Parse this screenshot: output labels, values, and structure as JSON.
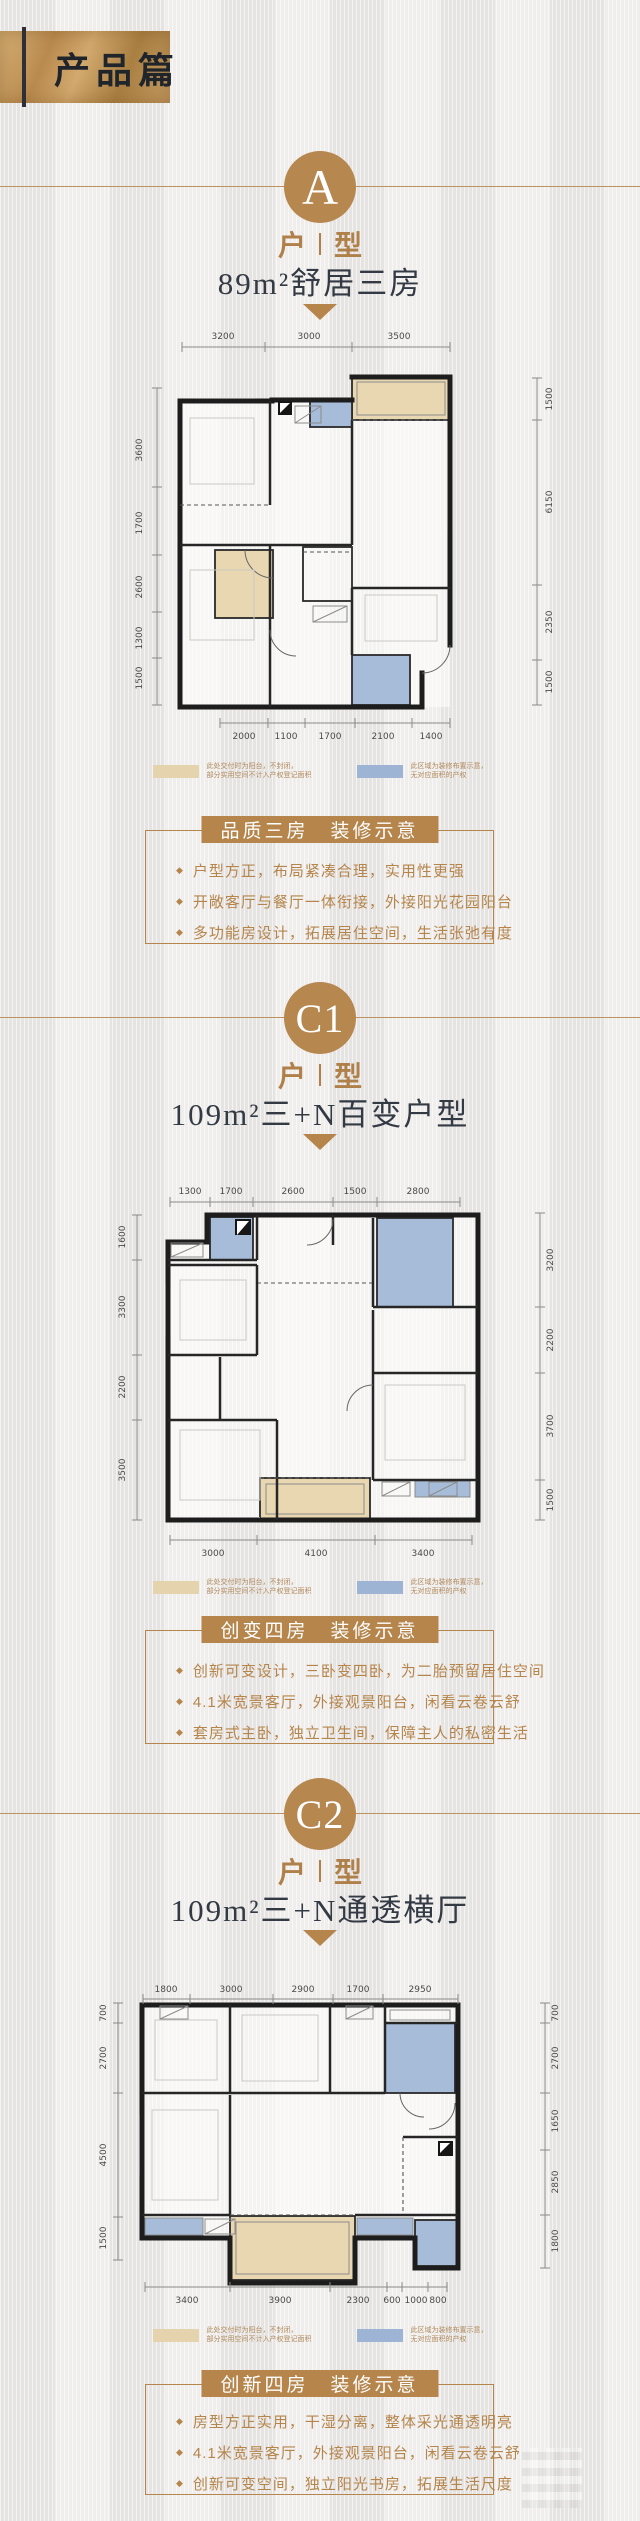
{
  "header": {
    "title": "产品篇"
  },
  "type_word": {
    "first": "户",
    "second": "型"
  },
  "ui": {
    "bullet_marker": "◆"
  },
  "colors": {
    "accent_gold": "#b6874e",
    "title_dark": "#333a44",
    "wall": "#1d1d1d",
    "balcony_tan": "#e9d7b2",
    "decor_blue": "#a6bcd8",
    "background": "#eceae8"
  },
  "legend": {
    "balcony_color": "#e5d3ad",
    "decor_color": "#9db4d4",
    "balcony_note_line1": "此处交付时为阳台，不封闭，",
    "balcony_note_line2": "部分实用空间不计入产权登记面积",
    "decor_note_line1": "此区域为装修布置示意，",
    "decor_note_line2": "无对应面积的产权"
  },
  "sections": [
    {
      "badge": "A",
      "subtitle": "89m²舒居三房",
      "plan": {
        "dims_top": [
          "3200",
          "3000",
          "3500"
        ],
        "dims_left": [
          "3600",
          "1700",
          "2600",
          "1300",
          "1500"
        ],
        "dims_right": [
          "1500",
          "6150",
          "2350",
          "1500"
        ],
        "dims_bottom": [
          "2000",
          "1100",
          "1700",
          "2100",
          "1400"
        ]
      },
      "info": {
        "title": "品质三房　装修示意",
        "bullets": [
          "户型方正，布局紧凑合理，实用性更强",
          "开敞客厅与餐厅一体衔接，外接阳光花园阳台",
          "多功能房设计，拓展居住空间，生活张弛有度"
        ]
      }
    },
    {
      "badge": "C1",
      "subtitle": "109m²三+N百变户型",
      "plan": {
        "dims_top": [
          "1300",
          "1700",
          "2600",
          "1500",
          "2800"
        ],
        "dims_left": [
          "1600",
          "3300",
          "2200",
          "3500"
        ],
        "dims_right": [
          "3200",
          "2200",
          "3700",
          "1500"
        ],
        "dims_bottom": [
          "3000",
          "4100",
          "3400"
        ]
      },
      "info": {
        "title": "创变四房　装修示意",
        "bullets": [
          "创新可变设计，三卧变四卧，为二胎预留居住空间",
          "4.1米宽景客厅，外接观景阳台，闲看云卷云舒",
          "套房式主卧，独立卫生间，保障主人的私密生活"
        ]
      }
    },
    {
      "badge": "C2",
      "subtitle": "109m²三+N通透横厅",
      "plan": {
        "dims_top": [
          "1800",
          "3000",
          "2900",
          "1700",
          "2950"
        ],
        "dims_left": [
          "700",
          "2700",
          "4500",
          "1500"
        ],
        "dims_right": [
          "700",
          "2700",
          "1650",
          "2850",
          "1800"
        ],
        "dims_bottom": [
          "3400",
          "3900",
          "2300",
          "600",
          "1000",
          "800"
        ]
      },
      "info": {
        "title": "创新四房　装修示意",
        "bullets": [
          "房型方正实用，干湿分离，整体采光通透明亮",
          "4.1米宽景客厅，外接观景阳台，闲看云卷云舒",
          "创新可变空间，独立阳光书房，拓展生活尺度"
        ]
      }
    }
  ]
}
